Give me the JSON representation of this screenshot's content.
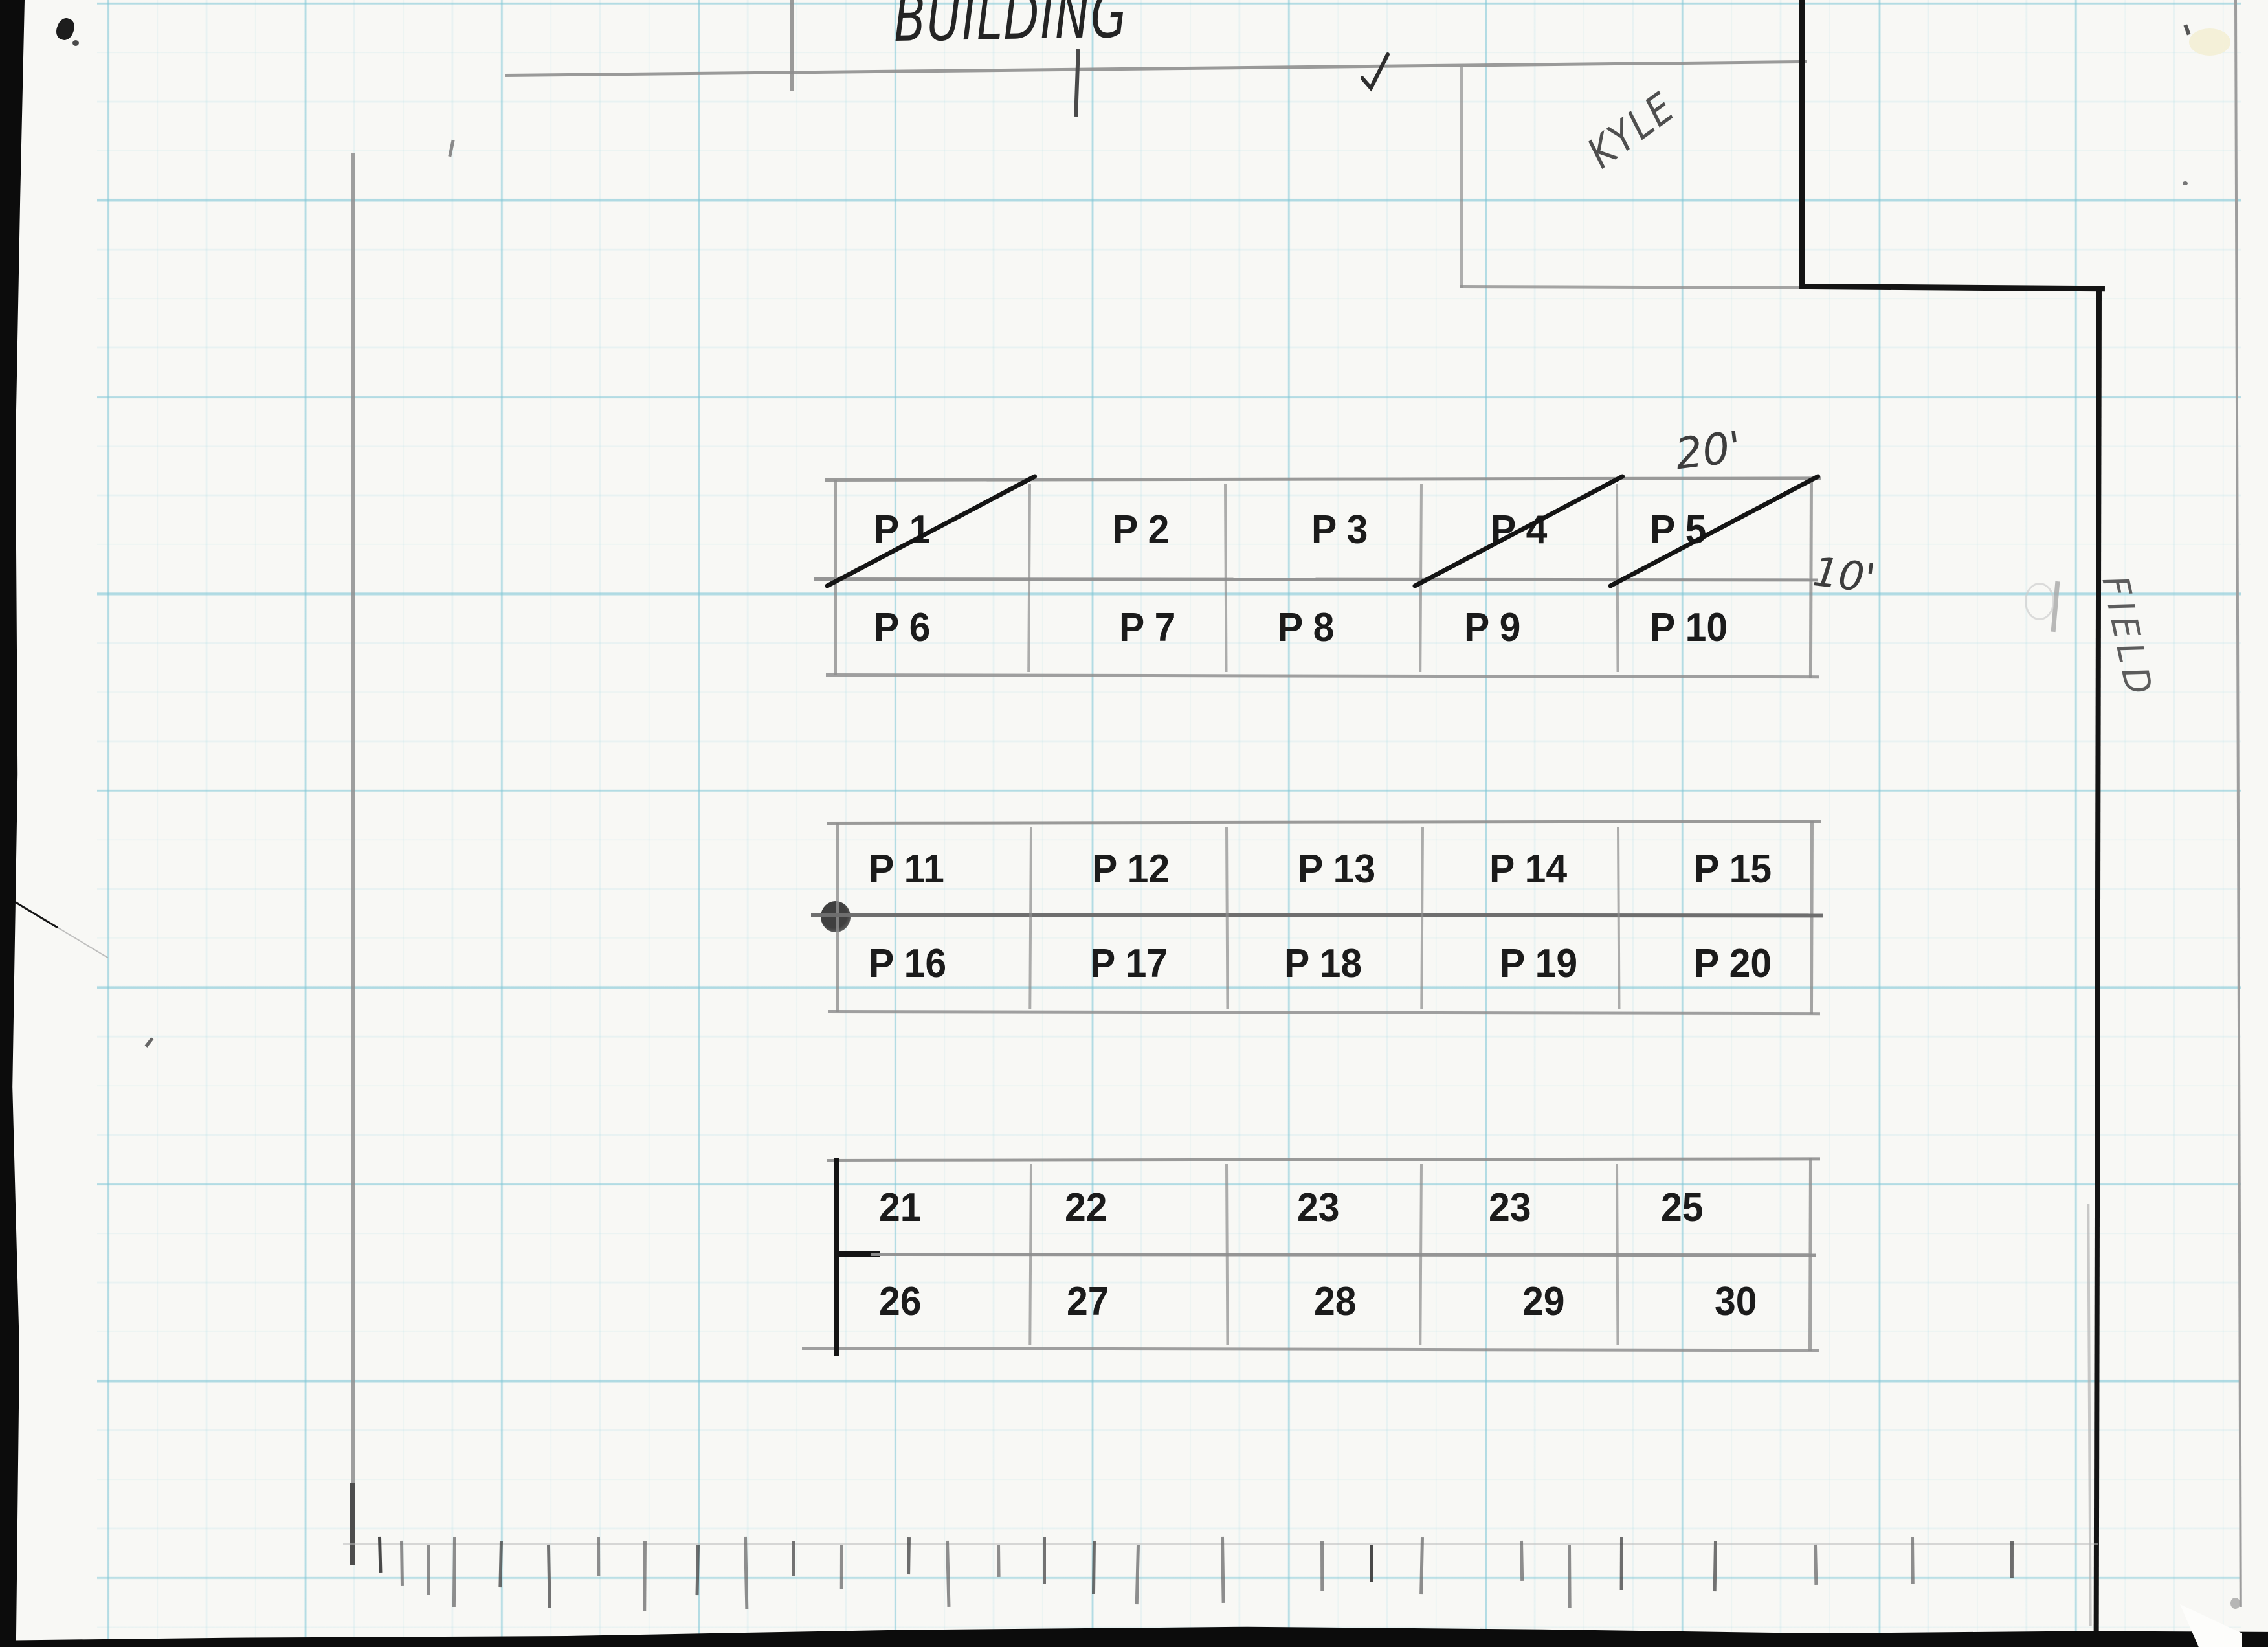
{
  "colors": {
    "paper": "#f8f8f5",
    "ink": "#141414",
    "pencil": "#8f8f8f",
    "pencil_dark": "#5a5a5a",
    "label": "#1b1b1b",
    "grid_major": "rgba(128,199,214,0.55)",
    "grid_minor": "rgba(150,212,224,0.16)",
    "scan_edge": "#0c0c0c"
  },
  "labels": {
    "building": "BUILDING",
    "kyle": "KYLE",
    "field": "FIELD",
    "dim_top": "20'",
    "dim_right": "10'"
  },
  "parking_blocks": [
    {
      "id": "block-1",
      "rows": [
        [
          "P 1",
          "P 2",
          "P 3",
          "P 4",
          "P 5"
        ],
        [
          "P 6",
          "P 7",
          "P 8",
          "P 9",
          "P 10"
        ]
      ],
      "crossed_out": [
        "P 1",
        "P 4",
        "P 5"
      ]
    },
    {
      "id": "block-2",
      "rows": [
        [
          "P 11",
          "P 12",
          "P 13",
          "P 14",
          "P 15"
        ],
        [
          "P 16",
          "P 17",
          "P 18",
          "P 19",
          "P 20"
        ]
      ],
      "crossed_out": []
    },
    {
      "id": "block-3",
      "rows": [
        [
          "21",
          "22",
          "23",
          "23",
          "25"
        ],
        [
          "26",
          "27",
          "28",
          "29",
          "30"
        ]
      ],
      "crossed_out": []
    }
  ]
}
